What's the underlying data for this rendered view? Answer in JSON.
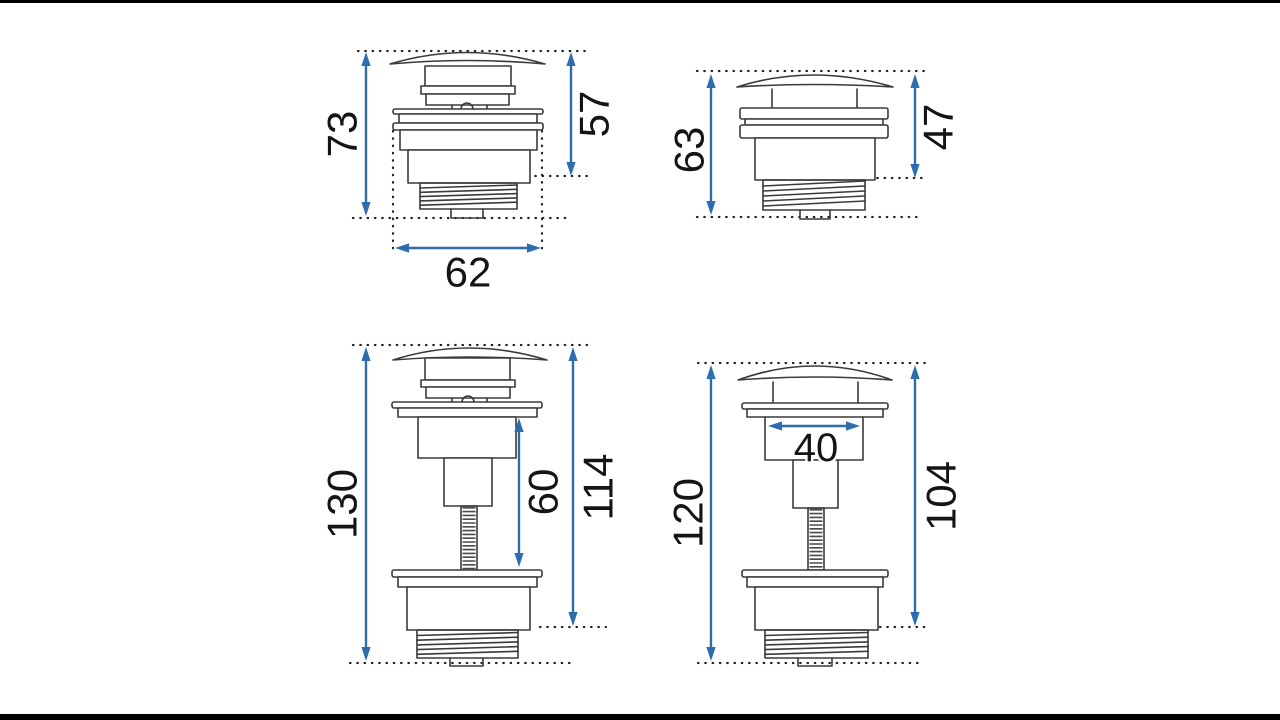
{
  "page": {
    "background_color": "#ffffff",
    "letterbox_color": "#000000"
  },
  "drawing": {
    "stroke_color": "#3a3a3a",
    "dimension_color": "#2e6dad",
    "label_color": "#141414",
    "figures": [
      {
        "position": "top-left",
        "dimensions": {
          "overall_height": "73",
          "upper_height": "57",
          "flange_width": "62"
        }
      },
      {
        "position": "top-right",
        "dimensions": {
          "overall_height": "63",
          "upper_height": "47"
        }
      },
      {
        "position": "bottom-left",
        "dimensions": {
          "overall_height": "130",
          "rod_section_height": "60",
          "main_height": "114"
        }
      },
      {
        "position": "bottom-right",
        "dimensions": {
          "overall_height": "120",
          "tube_width": "40",
          "main_height": "104"
        }
      }
    ]
  }
}
